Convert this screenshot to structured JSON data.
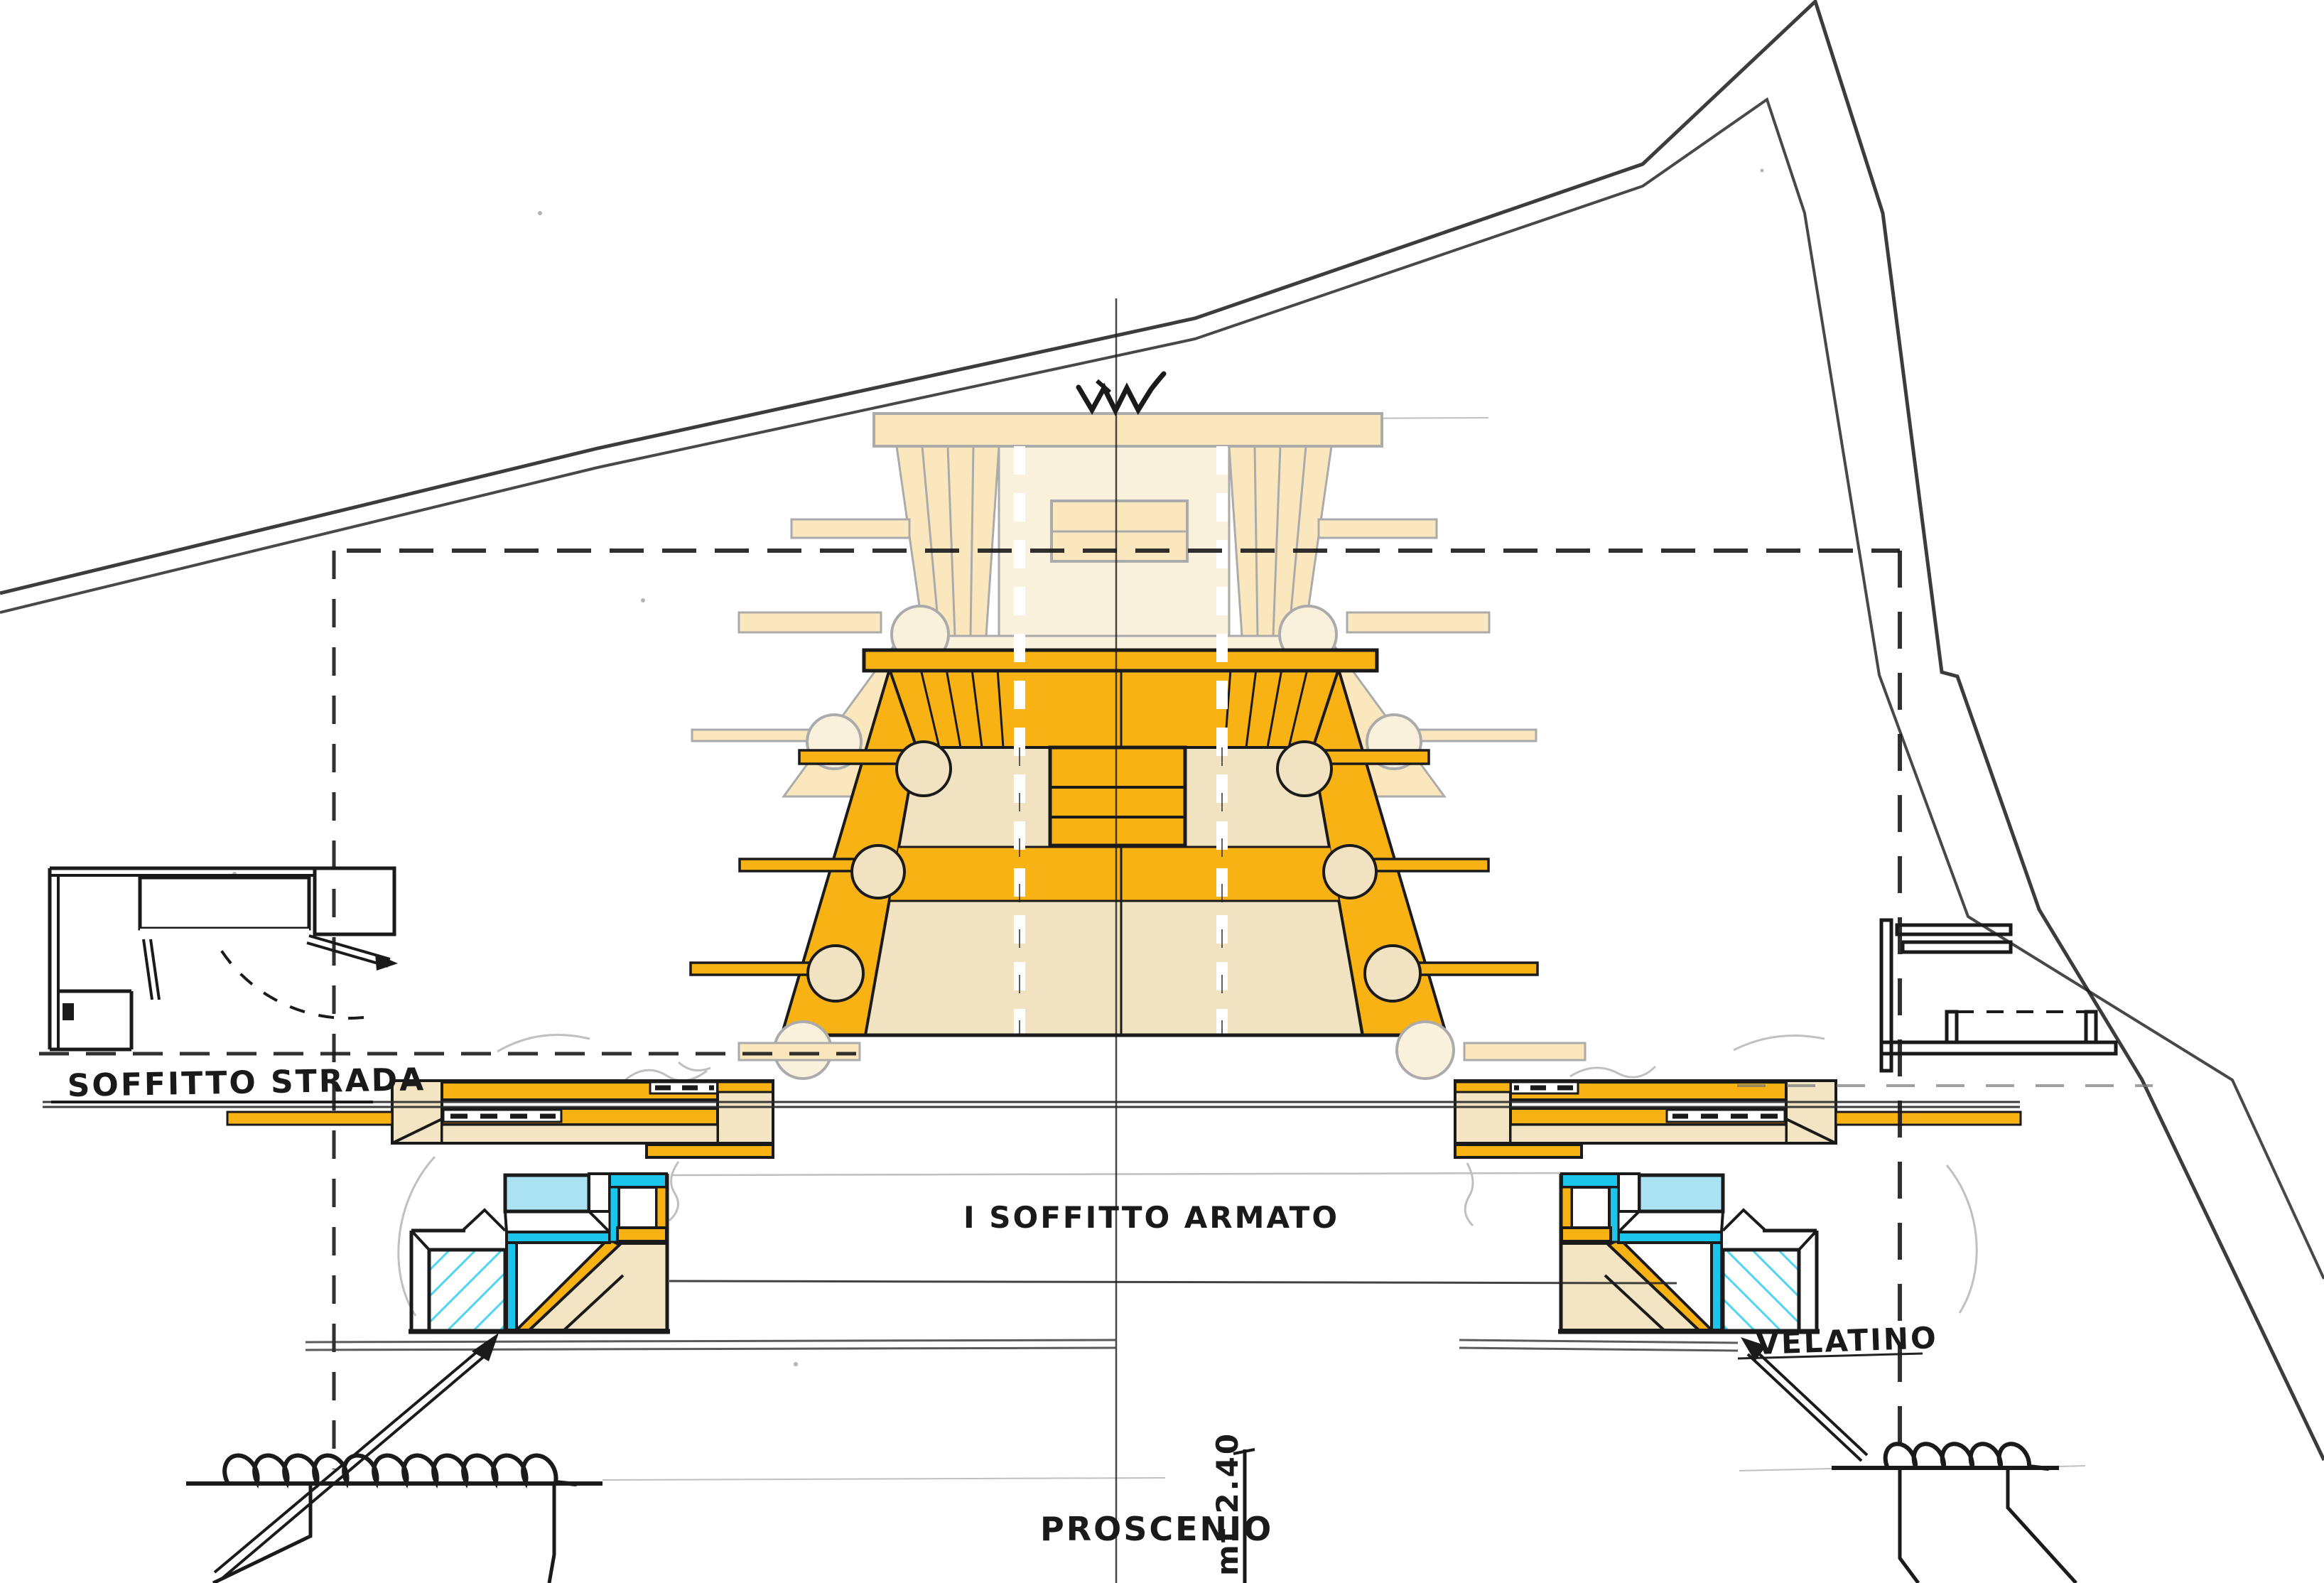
{
  "labels": {
    "soffitto_strada": "SOFFITTO STRADA",
    "soffitto_armato": "I SOFFITTO ARMATO",
    "velatino": "VELATINO",
    "proscenio": "PROSCENIO",
    "dimension": "mt 2.40"
  },
  "symbols": {
    "spring_zigzag": "spring-symbol",
    "wall_coil_left": "wall-break-coil",
    "wall_coil_right": "wall-break-coil"
  },
  "colors": {
    "orange": "#F9B213",
    "pale": "#FBE7BE",
    "pale_lighter": "#FAF1DC",
    "cream": "#F1E3C1",
    "beige": "#F3E5C4",
    "cyan": "#1CC5EC",
    "cyan_light": "#ABE3F4",
    "ink": "#1A1A1A",
    "pencil": "#8C8C8C",
    "ghost": "#ABABAB"
  }
}
